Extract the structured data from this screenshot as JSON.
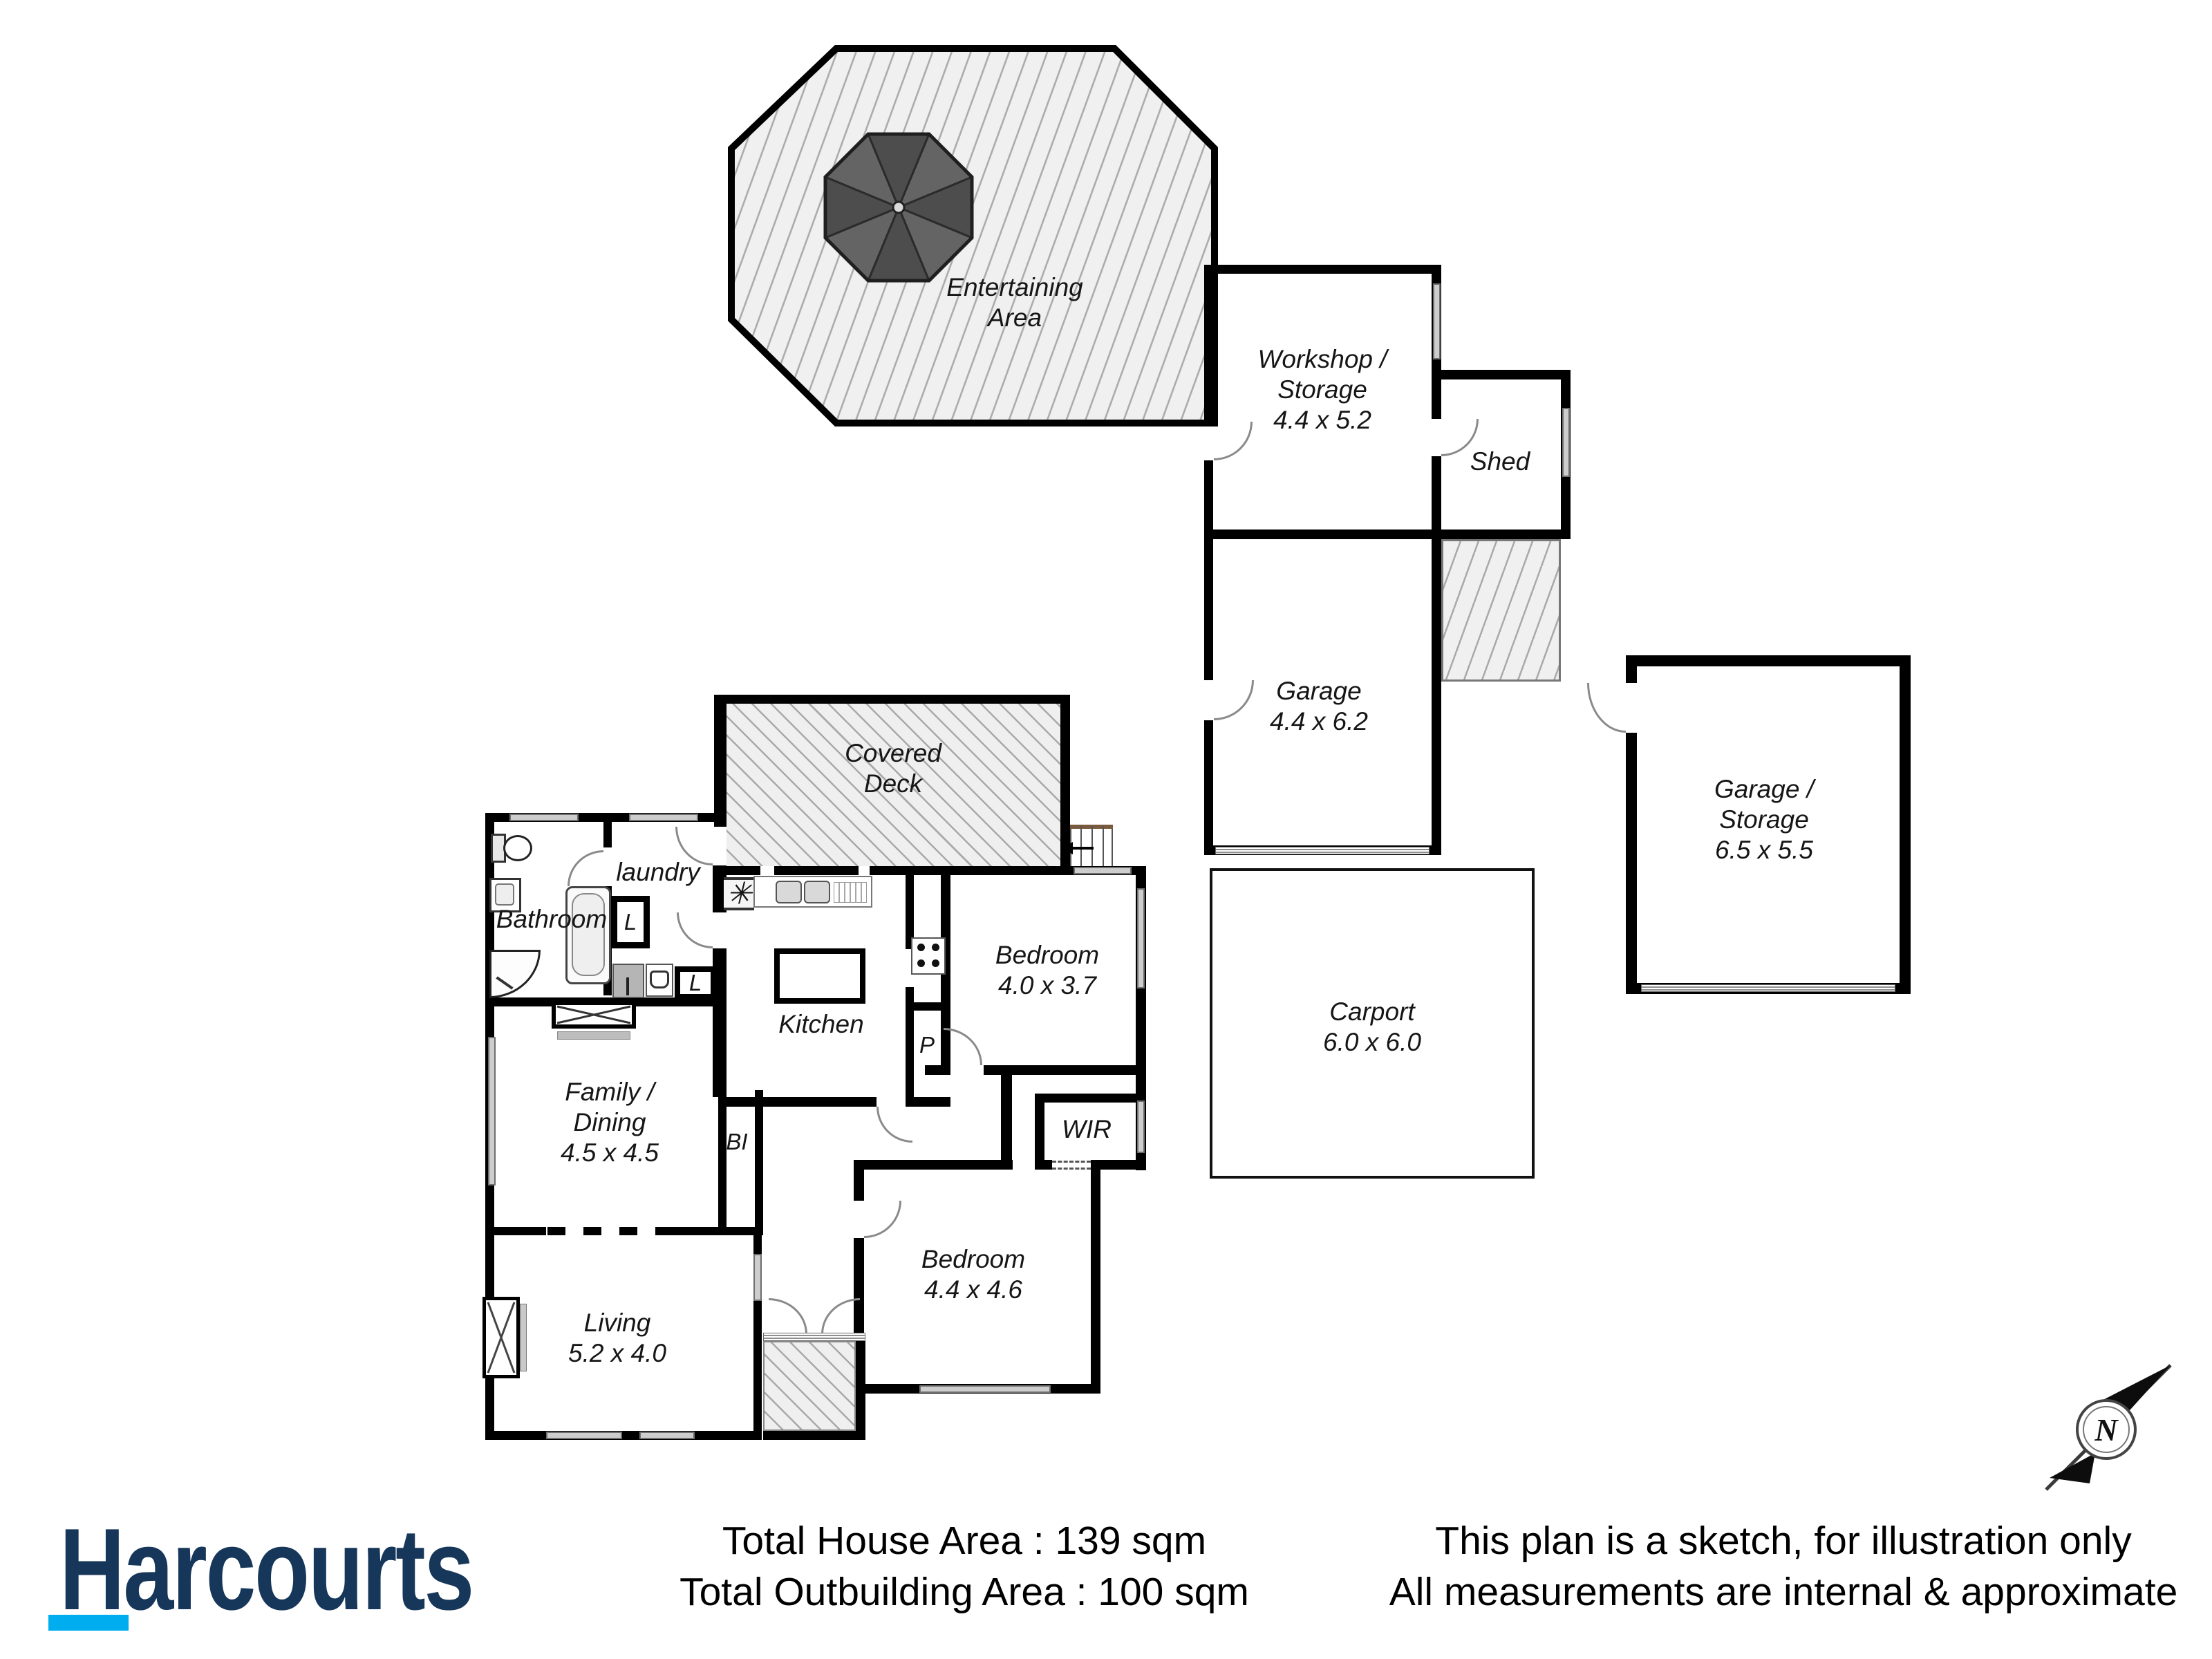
{
  "plan": {
    "areas": {
      "entertaining": {
        "line1": "Entertaining",
        "line2": "Area"
      },
      "workshop": {
        "line1": "Workshop /",
        "line2": "Storage",
        "line3": "4.4 x 5.2"
      },
      "shed": {
        "label": "Shed"
      },
      "garage": {
        "line1": "Garage",
        "line2": "4.4 x 6.2"
      },
      "garage_storage": {
        "line1": "Garage /",
        "line2": "Storage",
        "line3": "6.5 x 5.5"
      },
      "carport": {
        "line1": "Carport",
        "line2": "6.0 x 6.0"
      },
      "covered_deck": {
        "line1": "Covered",
        "line2": "Deck"
      },
      "bathroom": {
        "label": "Bathroom"
      },
      "laundry": {
        "label": "laundry"
      },
      "kitchen": {
        "label": "Kitchen"
      },
      "bedroom_front": {
        "line1": "Bedroom",
        "line2": "4.0 x 3.7"
      },
      "family_dining": {
        "line1": "Family /",
        "line2": "Dining",
        "line3": "4.5 x 4.5"
      },
      "living": {
        "line1": "Living",
        "line2": "5.2 x 4.0"
      },
      "wir": {
        "label": "WIR"
      },
      "bedroom_rear": {
        "line1": "Bedroom",
        "line2": "4.4 x 4.6"
      }
    },
    "small_labels": {
      "linen1": "L",
      "linen2": "L",
      "pantry": "P",
      "built_in": "BI"
    },
    "symbols": {
      "heater": "✳"
    },
    "compass": {
      "north_label": "N"
    }
  },
  "footer": {
    "brand": {
      "text": "Harcourts",
      "color": "#17375a",
      "underline_color": "#00aeef"
    },
    "totals": {
      "house": "Total House Area : 139 sqm",
      "outbuilding": "Total Outbuilding Area : 100 sqm"
    },
    "disclaimer": {
      "line1": "This plan is a sketch, for illustration only",
      "line2": "All measurements are internal & approximate"
    }
  }
}
